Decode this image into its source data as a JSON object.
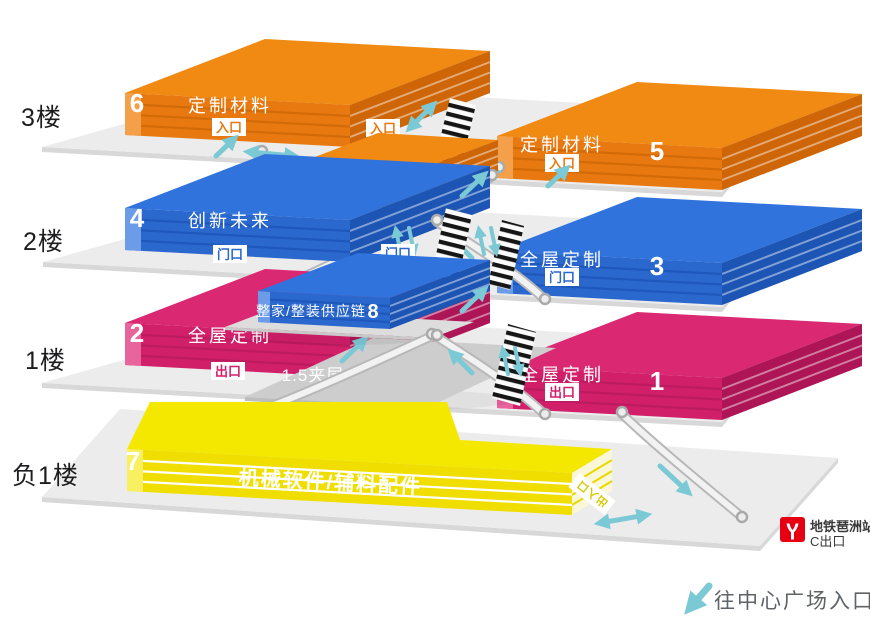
{
  "levels": [
    "3楼",
    "2楼",
    "1楼",
    "负1楼"
  ],
  "halls": [
    {
      "id": "6",
      "name": "定制材料",
      "door": "入口"
    },
    {
      "id": "5",
      "name": "定制材料",
      "door": "入口"
    },
    {
      "id": "4",
      "name": "创新未来",
      "door": "门口"
    },
    {
      "id": "3",
      "name": "全屋定制",
      "door": "门口"
    },
    {
      "id": "2",
      "name": "全屋定制",
      "door": "出口"
    },
    {
      "id": "1",
      "name": "全屋定制",
      "door": "出口"
    },
    {
      "id": "9",
      "name": "精品配材"
    },
    {
      "id": "8",
      "name": "整家/整装供应链"
    },
    {
      "id": "7",
      "name": "机械软件/辅料配件",
      "door": "出入口"
    }
  ],
  "mezzanine_label": "1.5夹层",
  "floating": {
    "entrance": "入口",
    "door": "门口"
  },
  "metro": {
    "line1": "地铁琶洲站",
    "line2": "C出口"
  },
  "footer": {
    "note": "往中心广场入口"
  },
  "colors": {
    "orange": "#E87911",
    "blue": "#2B68CE",
    "pink": "#D21F6A",
    "yellow": "#F0DE00",
    "teal": "#7CC9D6",
    "metro_red": "#E60012",
    "platform": "#ECECEC"
  }
}
